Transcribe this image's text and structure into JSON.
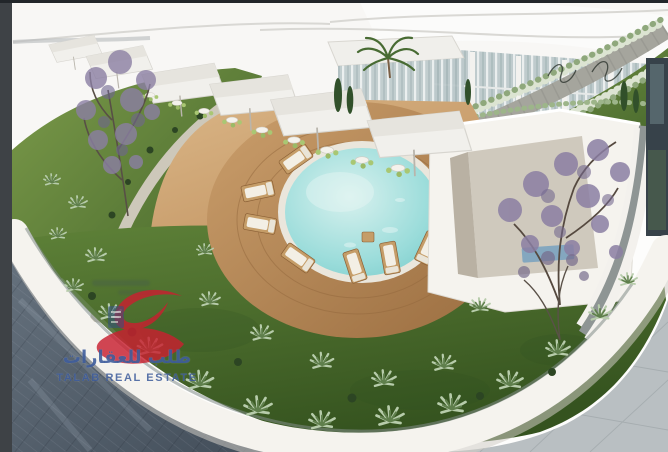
{
  "window": {
    "type": "real-estate-listing-photo",
    "subject": "Aerial 3D architectural rendering of a landscaped rooftop courtyard: circular pool on round wooden deck with sun loungers, cafe terrace with white canopies, curved white walls, lawns with agave plants, purple-blossom trees, dark tiled plaza"
  },
  "frame": {
    "left_border_color": "#3e4246",
    "top_strip_color": "#22262a"
  },
  "watermark": {
    "arabic_text": "طلب للعقارات",
    "english_text": "TALAB REAL ESTATE",
    "logo_color": "#c92030",
    "text_color": "#38589b",
    "badge_color": "#2e4b93"
  },
  "scene": {
    "colors": {
      "pool_center": "#d8f1ee",
      "pool_edge": "#7fcecd",
      "pool_rim": "#eae6dc",
      "deck_light": "#cb9f6c",
      "deck_dark": "#9a6d40",
      "sand_light": "#dab687",
      "sand_dark": "#bb8a57",
      "lawn_light": "#7b9a4a",
      "lawn_dark": "#3f6027",
      "berm_light": "#5e8138",
      "berm_dark": "#35531f",
      "plaza_light": "#67737f",
      "plaza_dark": "#414c58",
      "paving": "#b9bfc2",
      "wall": "#f5f3ee",
      "canopy": "#f1f0ec",
      "glass": "#bcc9cb",
      "tree_purple": "#8b7fa3",
      "chair_green": "#a9c773",
      "path_gravel": "#cdc8ba",
      "stone_path": "#a5a59d"
    }
  }
}
